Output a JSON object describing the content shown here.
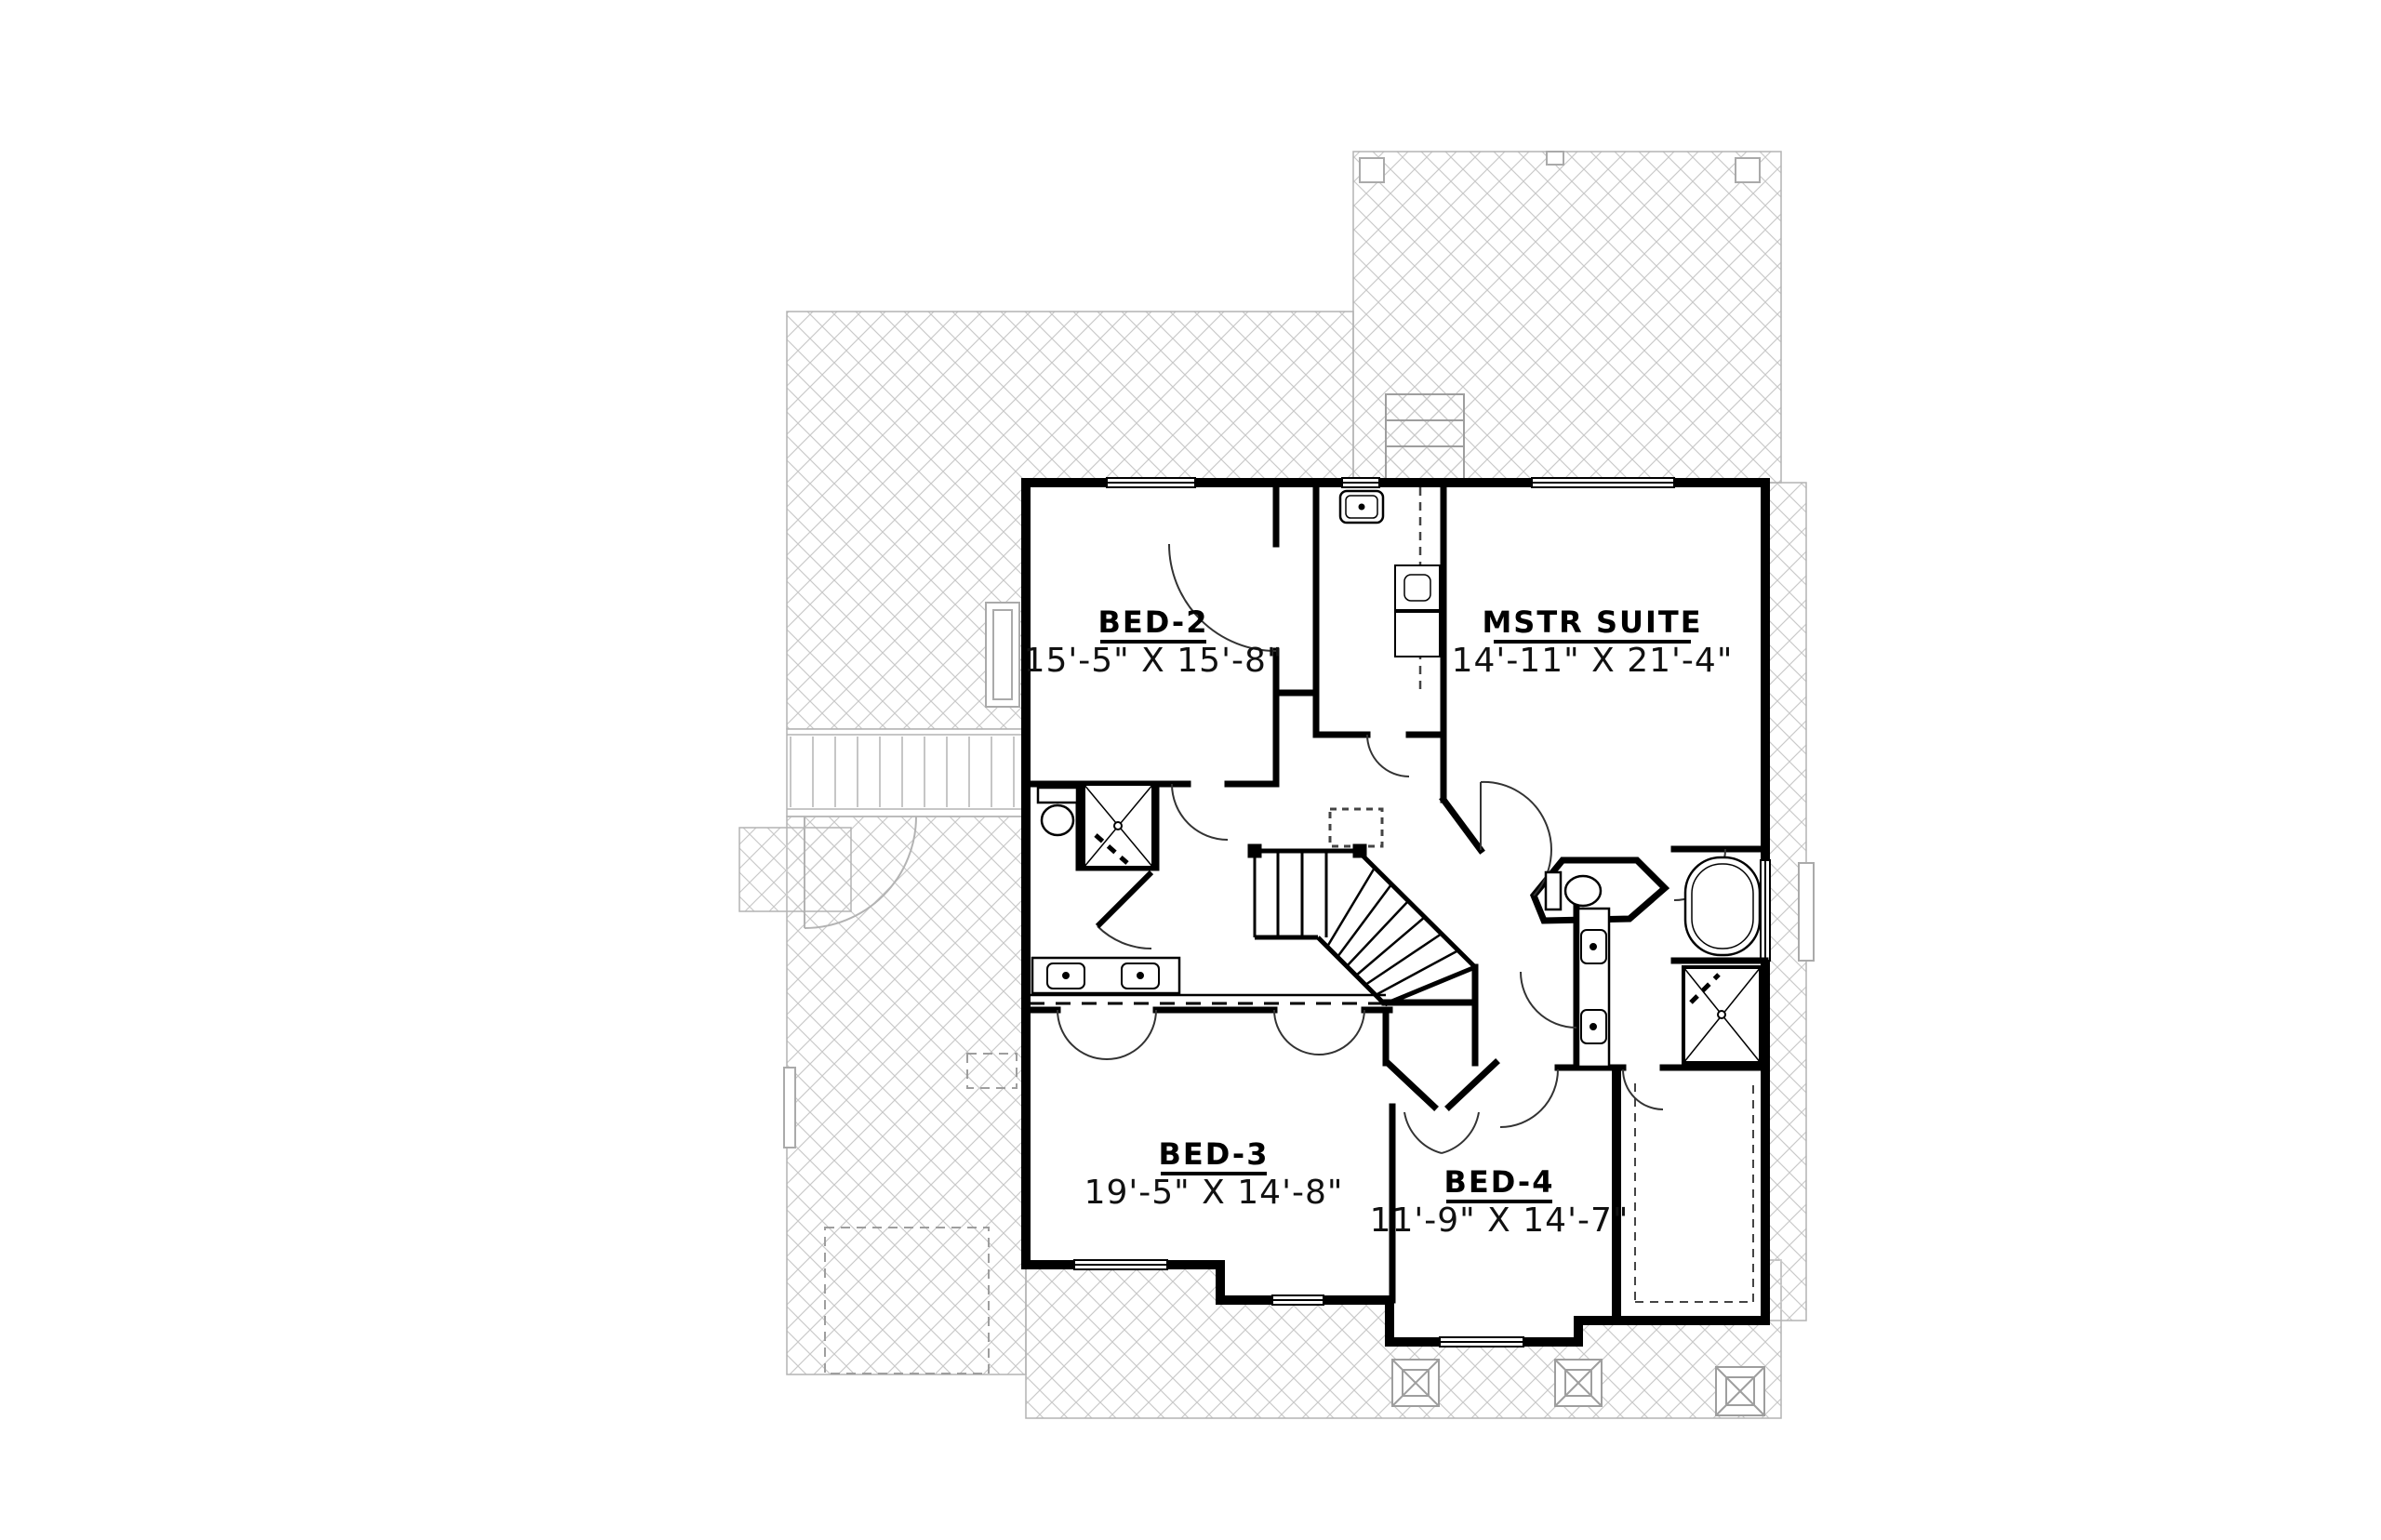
{
  "drawing": {
    "type": "floor-plan",
    "rooms": [
      {
        "id": "bed-2",
        "name": "BED-2",
        "dims": "15'-5\" X 15'-8\""
      },
      {
        "id": "mstr-suite",
        "name": "MSTR SUITE",
        "dims": "14'-11\" X 21'-4\""
      },
      {
        "id": "bed-3",
        "name": "BED-3",
        "dims": "19'-5\" X 14'-8\""
      },
      {
        "id": "bed-4",
        "name": "BED-4",
        "dims": "11'-9\" X 14'-7\""
      }
    ],
    "colors": {
      "wall": "#000000",
      "thin_line": "#333333",
      "roof_hatch": "#c9c9c9",
      "roof_edge": "#b3b3b3",
      "background": "#ffffff"
    }
  }
}
